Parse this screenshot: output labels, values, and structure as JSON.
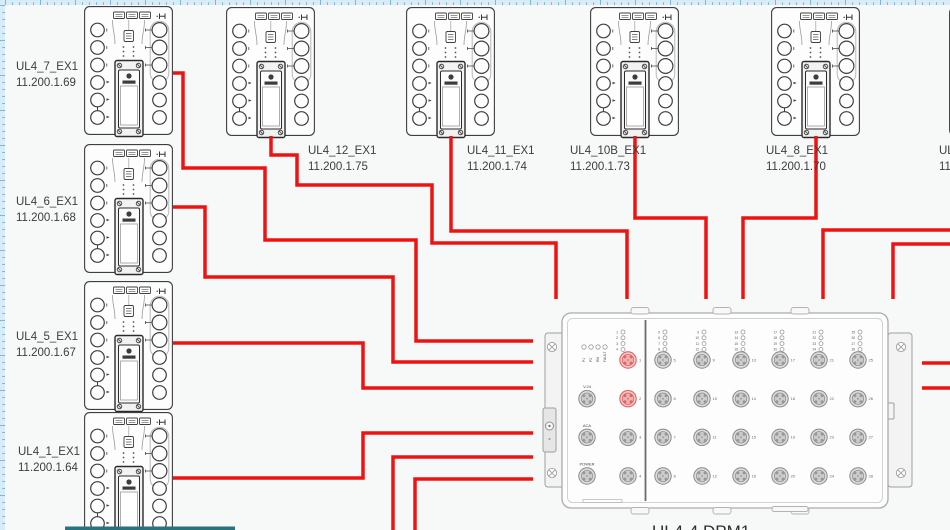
{
  "canvas": {
    "width": 950,
    "height": 530,
    "background": "#f7f8f8"
  },
  "rulers": {
    "bg": "#d8ecf8",
    "tick": "#74b2d6",
    "size": 5
  },
  "wire_color": "#ee1212",
  "ex1_devices": [
    {
      "id": "ul4-7-ex1",
      "label": "UL4_7_EX1",
      "ip": "11.200.1.69",
      "x": 84,
      "y": 6,
      "label_x": 16,
      "label_y": 60
    },
    {
      "id": "ul4-6-ex1",
      "label": "UL4_6_EX1",
      "ip": "11.200.1.68",
      "x": 84,
      "y": 144,
      "label_x": 16,
      "label_y": 195
    },
    {
      "id": "ul4-5-ex1",
      "label": "UL4_5_EX1",
      "ip": "11.200.1.67",
      "x": 84,
      "y": 281,
      "label_x": 16,
      "label_y": 330
    },
    {
      "id": "ul4-1-ex1",
      "label": "UL4_1_EX1",
      "ip": "11.200.1.64",
      "x": 84,
      "y": 412,
      "label_x": 18,
      "label_y": 445
    },
    {
      "id": "ul4-12-ex1",
      "label": "UL4_12_EX1",
      "ip": "11.200.1.75",
      "x": 226,
      "y": 7,
      "label_x": 308,
      "label_y": 144
    },
    {
      "id": "ul4-11-ex1",
      "label": "UL4_11_EX1",
      "ip": "11.200.1.74",
      "x": 406,
      "y": 7,
      "label_x": 467,
      "label_y": 144
    },
    {
      "id": "ul4-10b-ex1",
      "label": "UL4_10B_EX1",
      "ip": "11.200.1.73",
      "x": 590,
      "y": 7,
      "label_x": 570,
      "label_y": 144
    },
    {
      "id": "ul4-8-ex1",
      "label": "UL4_8_EX1",
      "ip": "11.200.1.70",
      "x": 771,
      "y": 7,
      "label_x": 766,
      "label_y": 144
    },
    {
      "id": "ul4-right-partial",
      "label": "UL",
      "ip": "11",
      "x": 949,
      "y": 7,
      "label_x": 939,
      "label_y": 144
    }
  ],
  "wires": [
    {
      "name": "wire-ul4-7-to-dpm",
      "path": "M173,73 H183 V168 H265 V240 H416 V341 H533"
    },
    {
      "name": "wire-ul4-6-to-dpm",
      "path": "M173,207 H205 V277 H393 V362 H533"
    },
    {
      "name": "wire-ul4-5-to-dpm",
      "path": "M173,343 H363 V388 H533"
    },
    {
      "name": "wire-ul4-1-to-dpm",
      "path": "M173,478 H363 V433 H533"
    },
    {
      "name": "wire-ul4-12-to-dpm",
      "path": "M271,136 V155 H297 V185 H432 V243 H556 V299"
    },
    {
      "name": "wire-ul4-11-to-dpm",
      "path": "M451,136 V231 H627 V299"
    },
    {
      "name": "wire-ul4-10b-to-dpm",
      "path": "M635,136 V218 H706 V299"
    },
    {
      "name": "wire-ul4-8-to-dpm",
      "path": "M816,136 V218 H743 V299"
    },
    {
      "name": "wire-right-offscreen-1",
      "path": "M950,230 H823 V299"
    },
    {
      "name": "wire-right-offscreen-2",
      "path": "M950,244 H893 V299"
    },
    {
      "name": "wire-bottom-offscreen-1",
      "path": "M393,531 V457 H533"
    },
    {
      "name": "wire-bottom-offscreen-2",
      "path": "M415,531 V479 H533"
    },
    {
      "name": "wire-dpm-right-1",
      "path": "M922,363 H950"
    },
    {
      "name": "wire-dpm-right-2",
      "path": "M922,388 H950"
    }
  ],
  "dpm": {
    "label": "UL4-4 DPM1",
    "x": 545,
    "y": 305,
    "label_x": 652,
    "label_y": 522,
    "status_leds": [
      "P1",
      "P2",
      "RM",
      "FAULT"
    ],
    "aux_ports": [
      "V.24",
      "ACA",
      "POWER"
    ],
    "left_port_numbers": [
      1,
      2,
      3,
      4
    ],
    "highlighted_ports": [
      1,
      2
    ],
    "grid": {
      "rows": 4,
      "cols": 6,
      "first": 5,
      "last": 28
    }
  },
  "partial_object_bottom": {
    "x": 65,
    "y": 526.5,
    "width": 170,
    "height": 3.5,
    "color": "#27737e"
  }
}
